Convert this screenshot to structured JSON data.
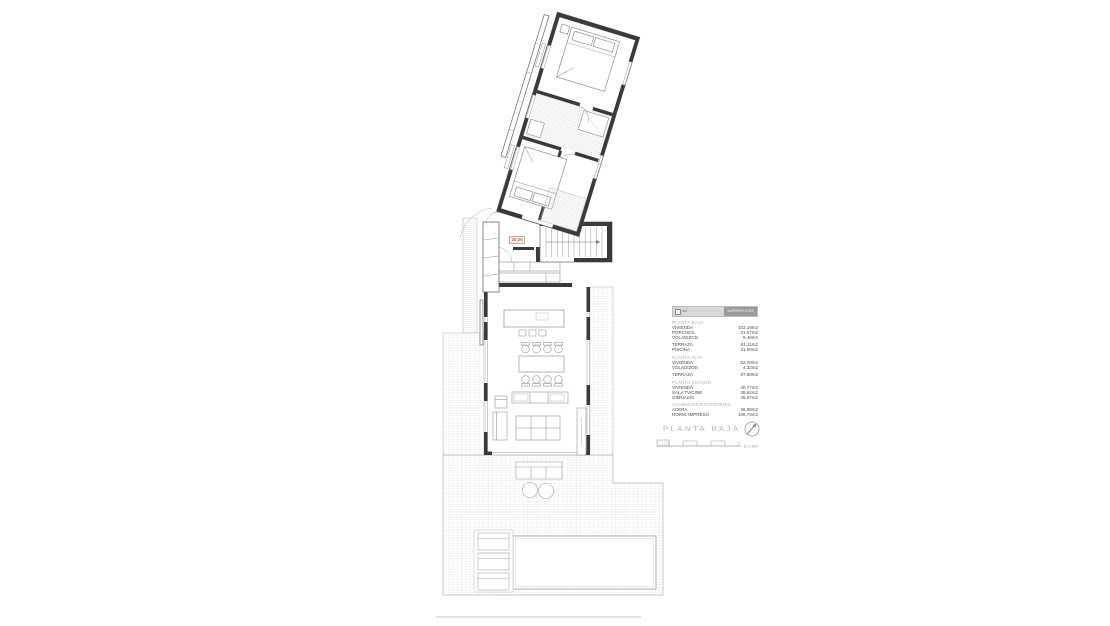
{
  "plan": {
    "title": "PLANTA BAJA",
    "scale_label": "E 1:100",
    "level_marker": "25.26"
  },
  "legend": {
    "header": {
      "left": "m2",
      "right": "SUPERFICIES"
    },
    "sections": [
      {
        "name": "PLANTA BAJA",
        "rows": [
          {
            "label": "VIVIENDA",
            "value": "103.19m2"
          },
          {
            "label": "PORCHES",
            "value": "21.07m2"
          },
          {
            "label": "VOLADIZOS",
            "value": "8.40m2"
          }
        ]
      },
      {
        "name": "",
        "rows": [
          {
            "label": "TERRAZA",
            "value": "81.11m2"
          },
          {
            "label": "PISCINA",
            "value": "31.50m2"
          }
        ]
      },
      {
        "name": "PLANTA ALTA",
        "rows": [
          {
            "label": "VIVIENDA",
            "value": "82.78m2"
          },
          {
            "label": "VOLADIZOS",
            "value": "4.32m2"
          }
        ]
      },
      {
        "name": "",
        "rows": [
          {
            "label": "TERRAZA",
            "value": "87.59m2"
          }
        ]
      },
      {
        "name": "PLANTA SOTANO",
        "rows": [
          {
            "label": "VIVIENDA",
            "value": "40.77m2"
          },
          {
            "label": "SALA TV/CINE",
            "value": "39.62m2"
          },
          {
            "label": "GIMNASIO",
            "value": "35.07m2"
          }
        ]
      },
      {
        "name": "ACABADOS EXTERIORES",
        "rows": [
          {
            "label": "ACERA",
            "value": "36.98m2"
          },
          {
            "label": "HORM. IMPRESO",
            "value": "106.73m2"
          }
        ]
      }
    ]
  },
  "colors": {
    "wall": "#3a3a3a",
    "drawing_line": "#9a9a9a",
    "tile_line": "#d9d9d9",
    "accent_red": "#c0392b",
    "legend_header_bg": "#d8d8d8",
    "legend_header_dark": "#9a9a9a",
    "section_text": "#a9b2a9",
    "title_text": "#b5b5b5"
  }
}
